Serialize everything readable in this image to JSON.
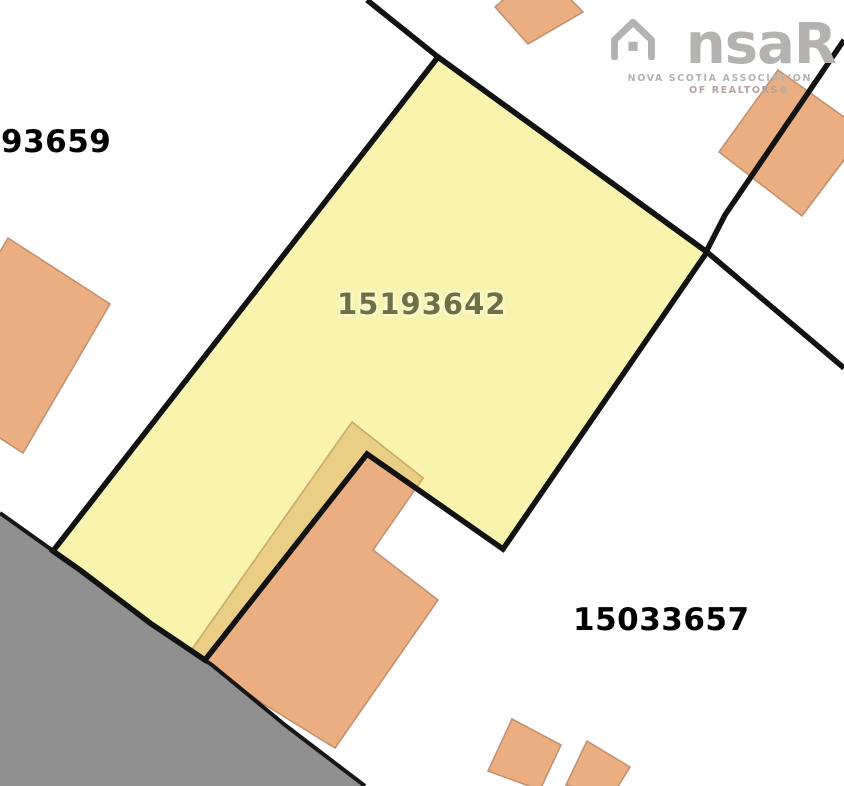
{
  "map": {
    "labels": {
      "subject_parcel_id": "15193642",
      "west_parcel_id": "93659",
      "southeast_parcel_id": "15033657"
    },
    "logo": {
      "brand_prefix": "ns",
      "brand_suffix": "aR",
      "org_line1": "NOVA SCOTIA ASSOCIATION",
      "org_line2": "OF REALTORS®"
    },
    "icons": {
      "logo_house_icon": "house-outline"
    },
    "colors": {
      "subject_parcel_fill": "#F8F4AD",
      "building_fill": "#EAAE80",
      "building_shaded_fill": "#EACE86",
      "road_fill": "#909090",
      "boundary_stroke": "#121212",
      "building_stroke": "#C19272",
      "subject_label_color": "#6F7144",
      "neighbor_label_color": "#000000",
      "logo_color": "#B5B3B1"
    }
  }
}
